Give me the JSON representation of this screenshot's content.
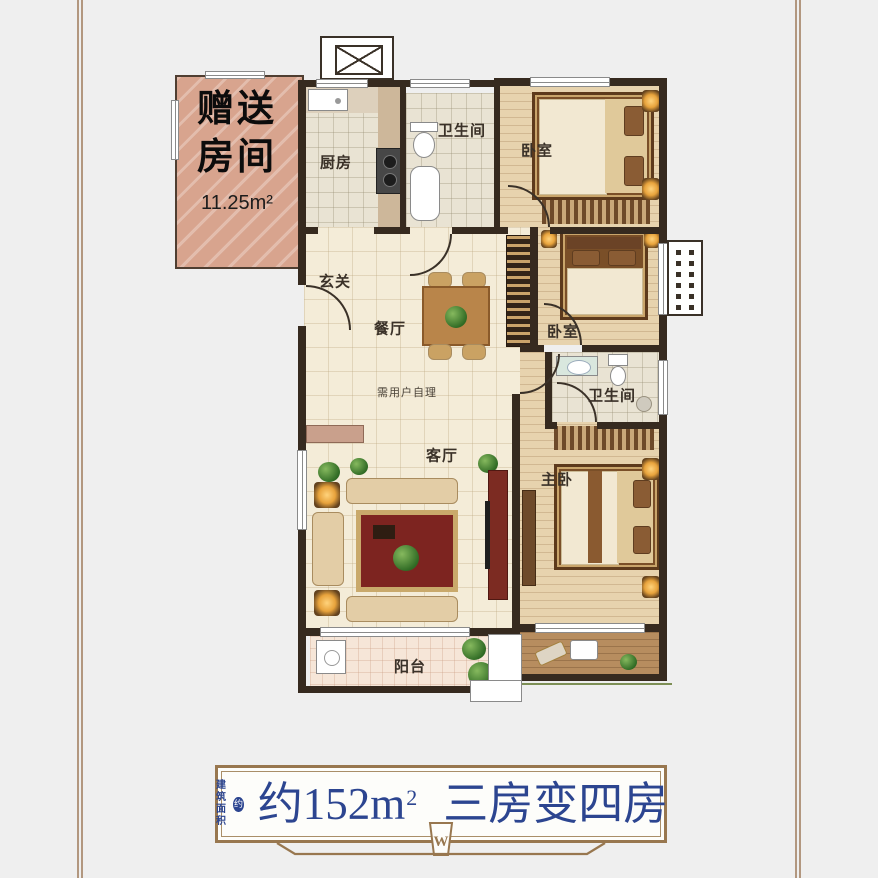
{
  "page": {
    "background": "#efefef",
    "frame_color": "#b2977f"
  },
  "plan": {
    "gift_room": {
      "line1": "赠送",
      "line2": "房间",
      "area": "11.25m²"
    },
    "labels": {
      "kitchen": "厨房",
      "bath1": "卫生间",
      "bedroom1": "卧室",
      "foyer": "玄关",
      "dining": "餐厅",
      "note": "需用户自理",
      "bedroom2": "卧室",
      "bath2": "卫生间",
      "living": "客厅",
      "master": "主卧",
      "balcony": "阳台"
    },
    "wall_color": "#362a1f",
    "gift_room_color": "#d8a48e"
  },
  "footer": {
    "prefix_line1": "建筑",
    "prefix_line2": "面积",
    "prefix_badge": "约",
    "area": "约152m",
    "area_sup": "2",
    "title": "三房变四房",
    "emblem": "W",
    "text_color": "#2c4590",
    "frame_color": "#98774f"
  }
}
